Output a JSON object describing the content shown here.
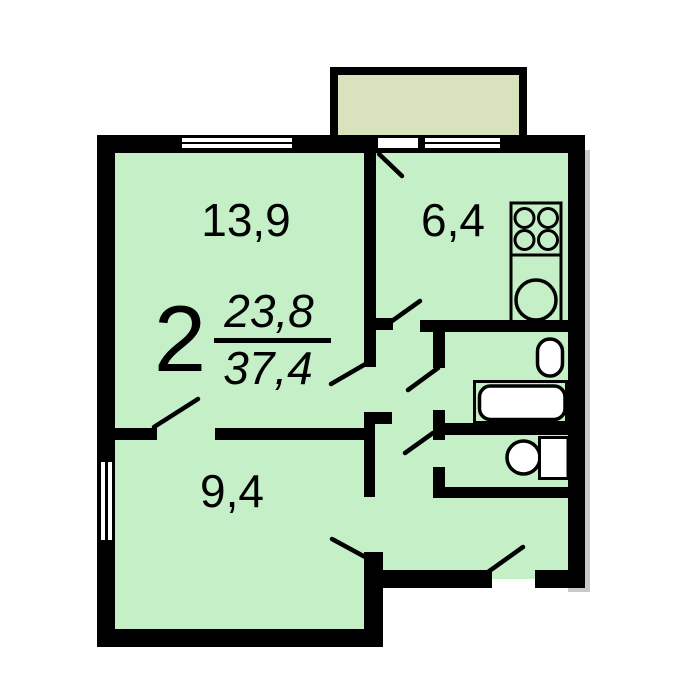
{
  "plan": {
    "title": "2-room apartment floor plan",
    "labels": {
      "room_count": "2",
      "living_area": "23,8",
      "total_area": "37,4",
      "room1_area": "13,9",
      "kitchen_area": "6,4",
      "room2_area": "9,4"
    },
    "colors": {
      "floor": "#c5efc6",
      "balcony": "#d8e3bd",
      "wall": "#000000",
      "fixture_fill": "#ffffff"
    },
    "icons": [
      "stove-icon",
      "kitchen-sink-icon",
      "toilet-icon",
      "bathtub-icon",
      "washbasin-icon",
      "cabinet-icon",
      "window-icon",
      "door-swing-icon"
    ]
  }
}
